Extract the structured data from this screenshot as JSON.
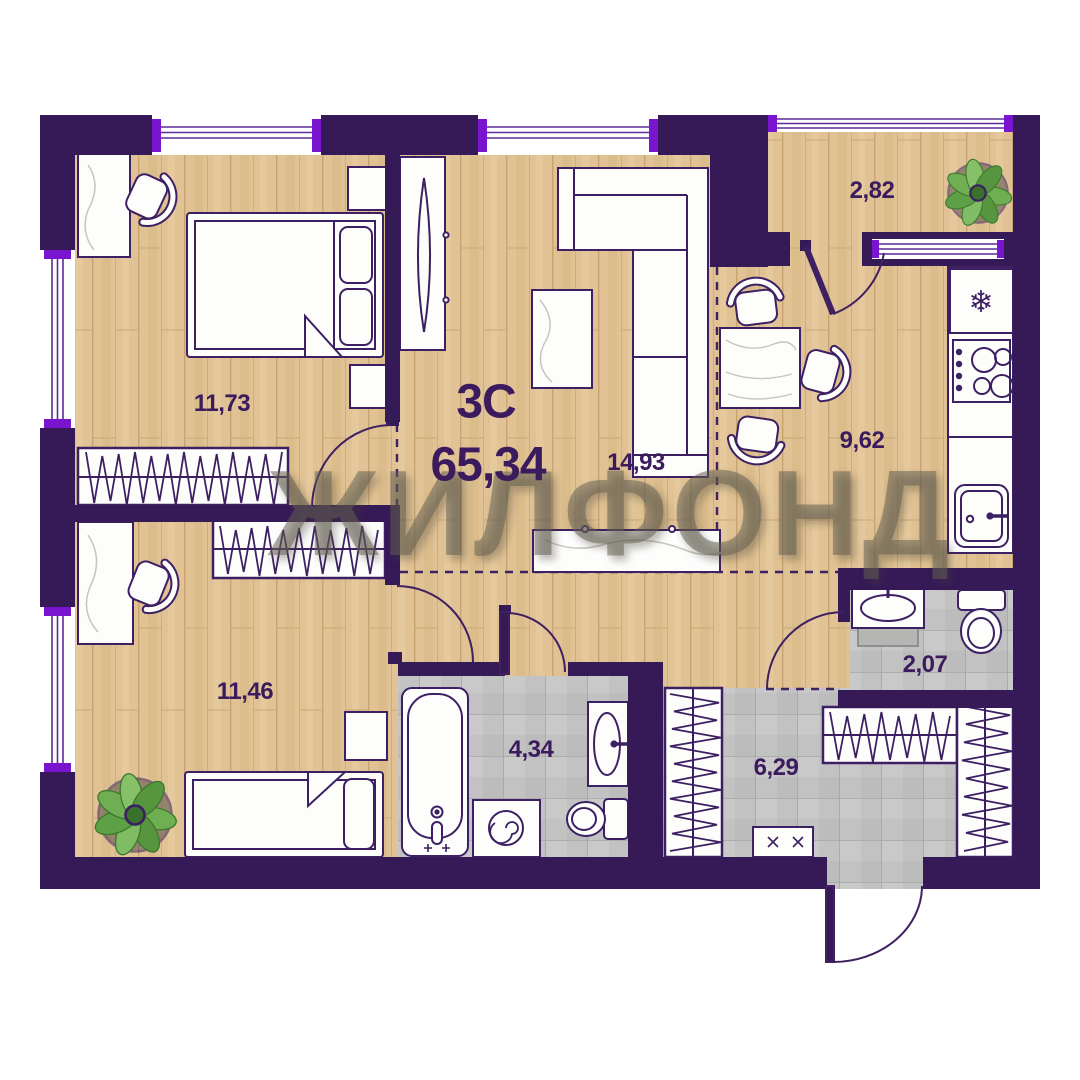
{
  "plan": {
    "type_label": "3С",
    "total_area": "65,34",
    "watermark": "ЖИЛФОНД",
    "rooms": [
      {
        "name": "bedroom-1",
        "area": "11,73"
      },
      {
        "name": "bedroom-2",
        "area": "11,46"
      },
      {
        "name": "living-room",
        "area": "14,93"
      },
      {
        "name": "kitchen",
        "area": "9,62"
      },
      {
        "name": "balcony",
        "area": "2,82"
      },
      {
        "name": "bathroom",
        "area": "4,34"
      },
      {
        "name": "wc",
        "area": "2,07"
      },
      {
        "name": "hallway",
        "area": "6,29"
      }
    ],
    "colors": {
      "wall": "#361a58",
      "accent": "#7a15cf",
      "wood_floor": "#e0c294",
      "tile_floor": "#c2c2c2",
      "label_text": "#3b1b5e",
      "furniture_outline": "#3d2063"
    }
  }
}
